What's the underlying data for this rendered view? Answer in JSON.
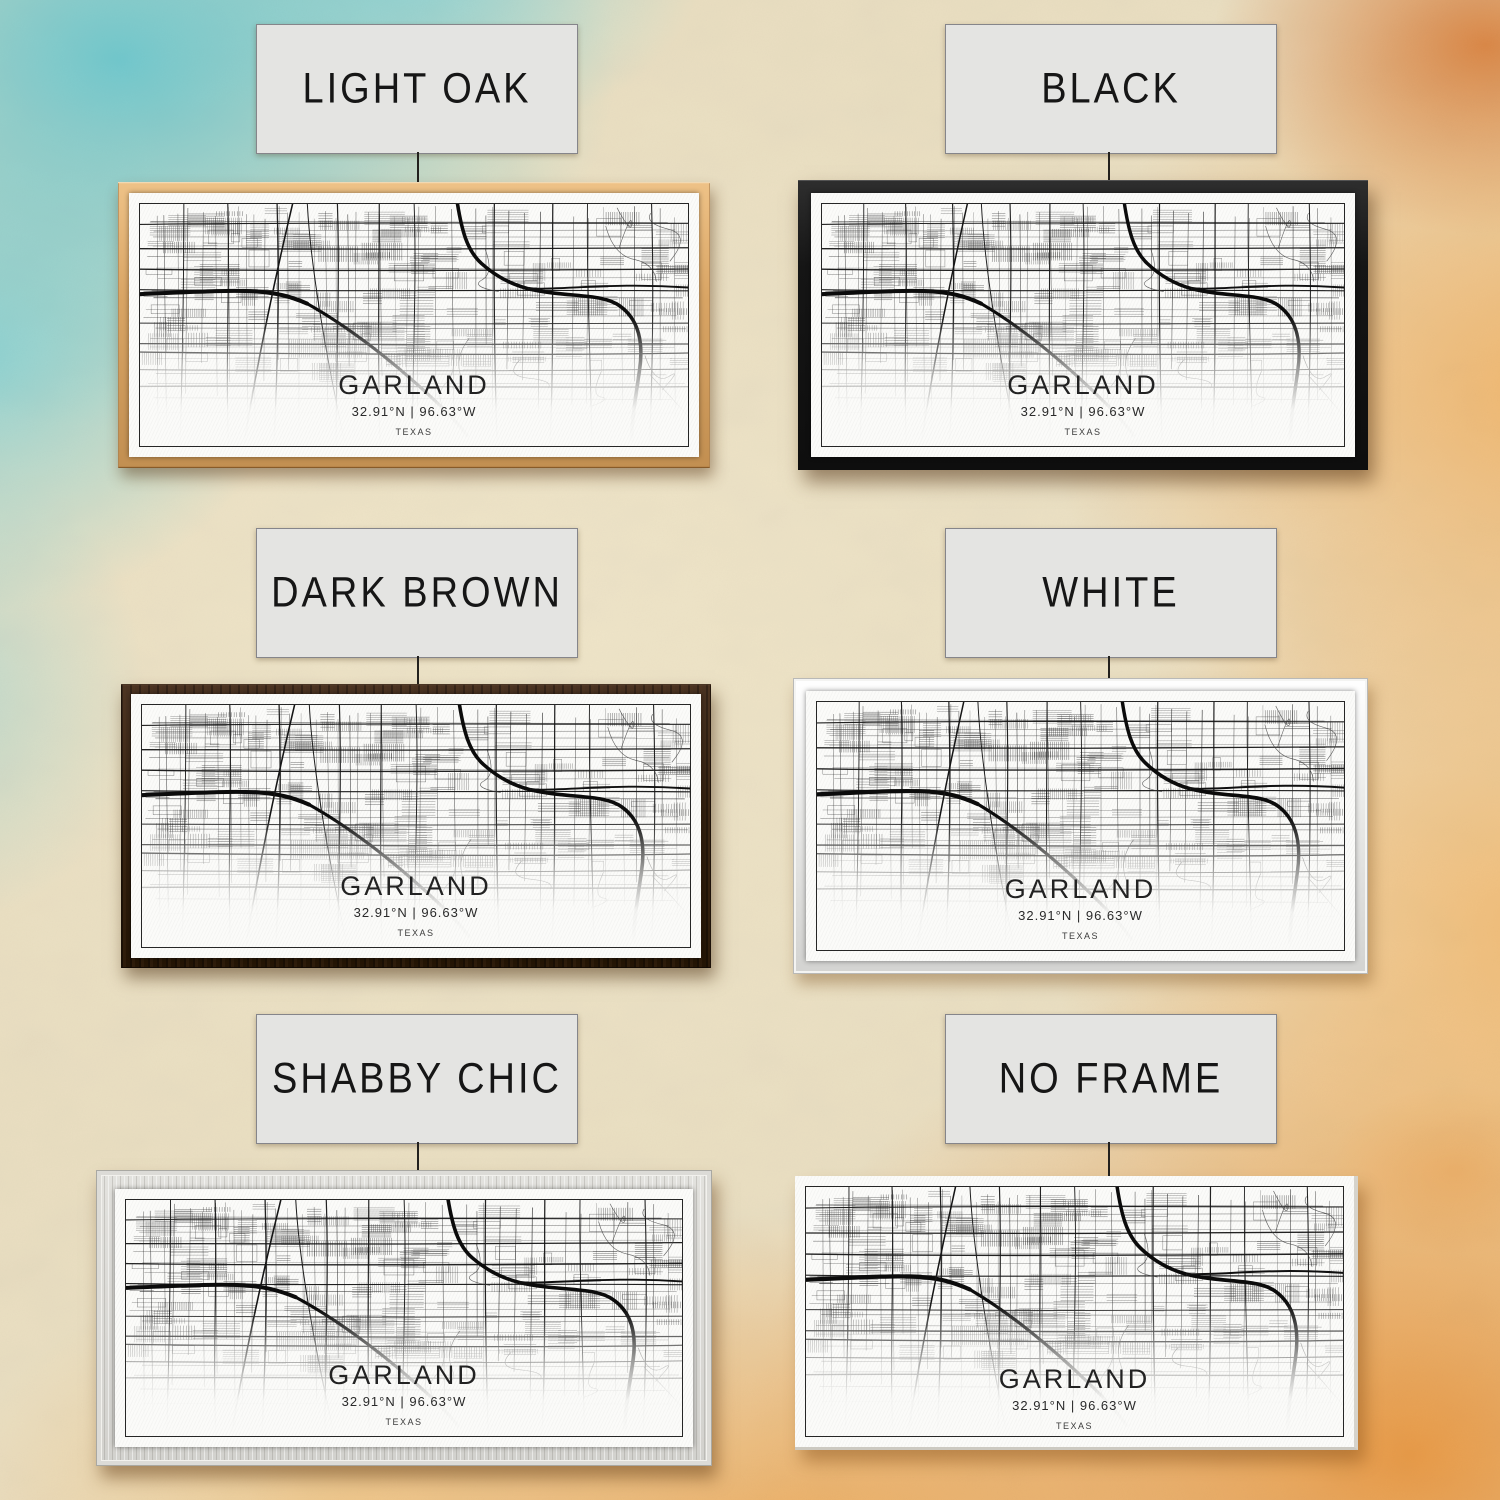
{
  "print": {
    "city": "GARLAND",
    "coordinates": "32.91°N | 96.63°W",
    "state": "TEXAS"
  },
  "options": [
    {
      "id": "light-oak",
      "label": "LIGHT OAK",
      "frame_color": "#d9a565"
    },
    {
      "id": "black",
      "label": "BLACK",
      "frame_color": "#161616"
    },
    {
      "id": "dark-brown",
      "label": "DARK BROWN",
      "frame_color": "#33200f"
    },
    {
      "id": "white",
      "label": "WHITE",
      "frame_color": "#ececea"
    },
    {
      "id": "shabby-chic",
      "label": "SHABBY CHIC",
      "frame_color": "#dcdbd7"
    },
    {
      "id": "no-frame",
      "label": "NO FRAME",
      "frame_color": null
    }
  ],
  "colors": {
    "label_card_bg": "#e4e4e2",
    "label_card_border": "#85858a",
    "connector_line": "#23211e",
    "print_background": "#fbfbf9",
    "map_ink": "#111111",
    "background_cream": "#eadfc2",
    "background_teal": "#6cc8cf",
    "background_orange": "#e99842"
  }
}
